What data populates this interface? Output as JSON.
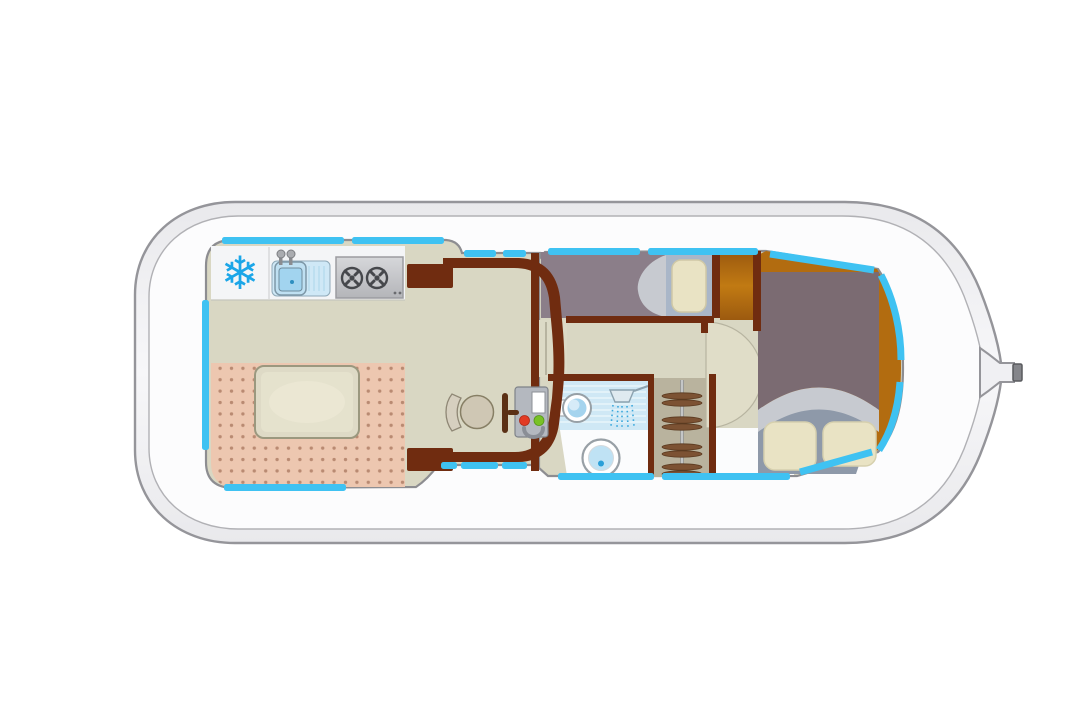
{
  "image": {
    "kind": "boat-deck-floor-plan",
    "width": 1092,
    "height": 723
  },
  "colors": {
    "hull": "#f1f1f4",
    "hull_outline": "#95959a",
    "deck": "#fcfcfd",
    "cabin_outline": "#8d8d91",
    "window": "#3fc2f2",
    "wall": "#702c10",
    "floor": "#d9d7c3",
    "step": "#dcdac6",
    "carpet": "#edc7b0",
    "carpet_dot": "#b98a72",
    "table": "#dedac6",
    "galley_counter": "#f4f5f7",
    "stove": "#c9cacd",
    "burner": "#46484c",
    "snowflake": "#1ba6e8",
    "sink": "#a2d4ef",
    "bow_floor": "#b26c10",
    "bed_single": "#8b7e89",
    "bed_double": "#7b6b72",
    "blanket": "#c7cad0",
    "pillow": "#e9e3c4",
    "pillow_base_single": "#a9b6c8",
    "pillow_base_double": "#8e99a9",
    "shower": "#cfe8f5",
    "fixture": "#ffffff",
    "water": "#bfe2f4",
    "water_dot": "#2a9fd8",
    "wardrobe": "#b9b39e",
    "hanger": "#7c5233",
    "console": "#b4b8bf",
    "button_red": "#e23b25",
    "button_green": "#79c226",
    "seat": "#cfc7b4",
    "lever": "#5b3015",
    "mast_tip": "#85868b"
  },
  "features": {
    "hull": {
      "bow_fitting": "mooring-post"
    },
    "galley": {
      "freezer_glyph": "❄",
      "appliances": [
        "freezer",
        "sink-with-faucet",
        "two-burner-stove"
      ]
    },
    "saloon": {
      "furniture": [
        "dinette-table",
        "dotted-carpet",
        "storage-cabinet-top",
        "storage-cabinet-bottom"
      ]
    },
    "helm": {
      "items": [
        "helm-seat",
        "throttle-lever",
        "helm-console",
        "console-screen",
        "red-button",
        "green-button",
        "steering-wheel",
        "entry-steps"
      ]
    },
    "mid_cabin": {
      "bed": "single-berth",
      "pillows": 1
    },
    "bathroom": {
      "fixtures": [
        "washbasin",
        "shower",
        "toilet"
      ]
    },
    "wardrobe": {
      "hanger_rows": 4
    },
    "fore_cabin": {
      "bed": "double-bed",
      "pillows": 2
    },
    "windows": {
      "segment_count": 17
    }
  }
}
